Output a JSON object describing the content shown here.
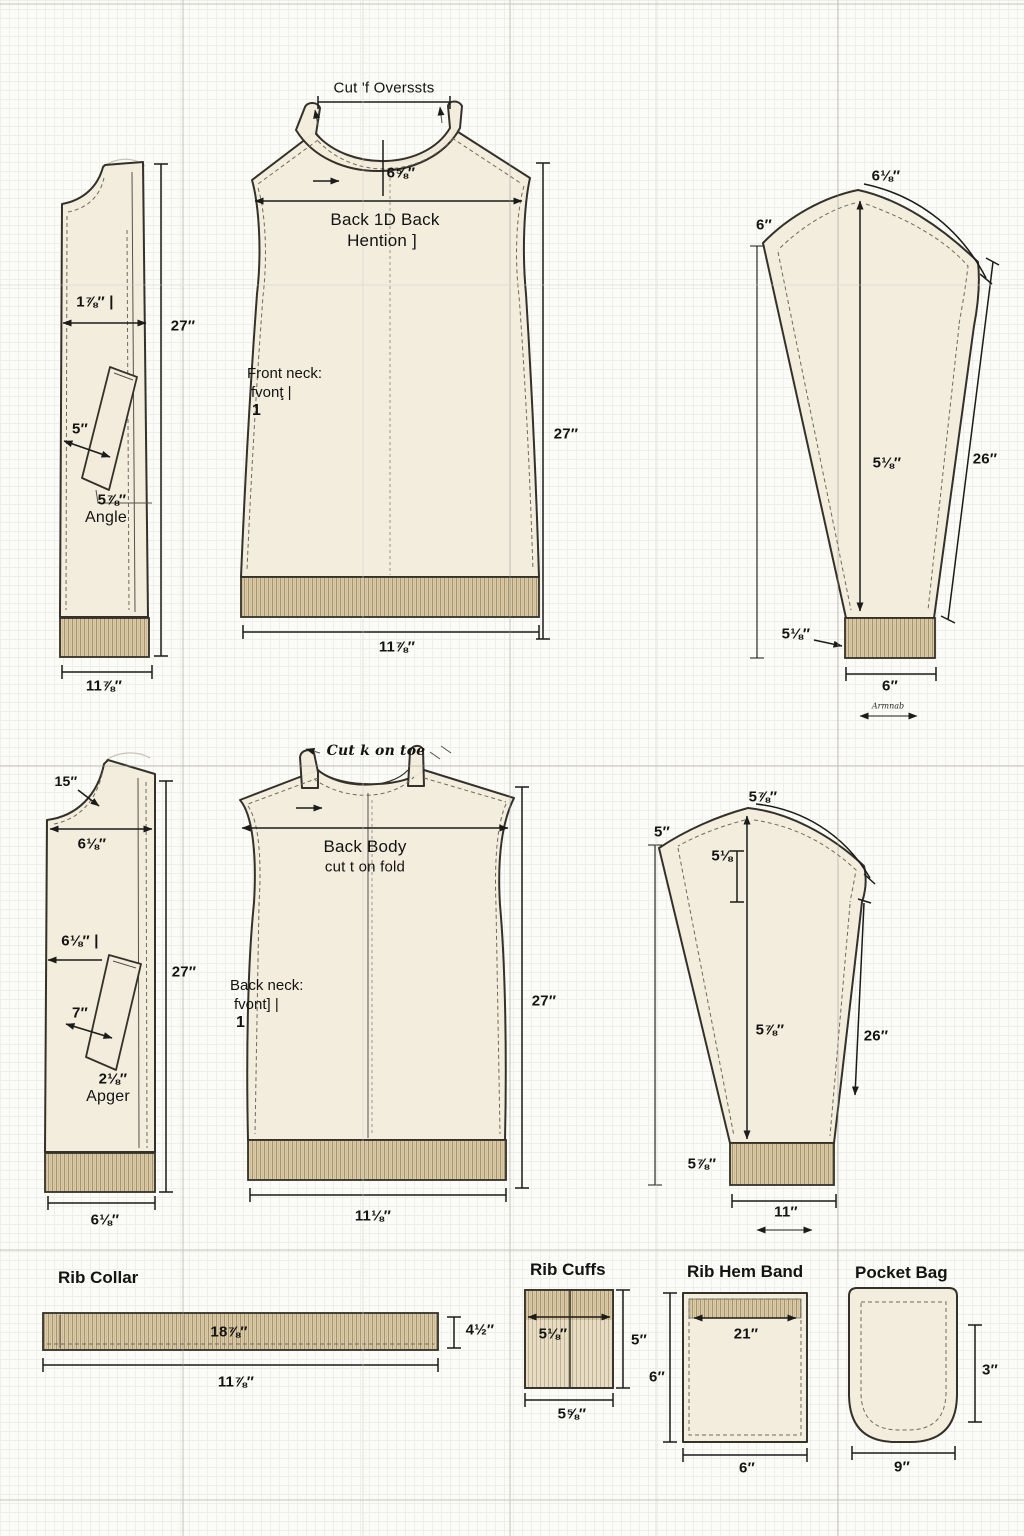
{
  "colors": {
    "fabric": "#f3ecdc",
    "rib_band": "#d9c9a7",
    "rib_line": "#a6946e",
    "outline": "#34312a",
    "paper": "#fbfbf7",
    "dimension": "#1b1b19"
  },
  "top_row": {
    "side_panel": {
      "width_dim": "1⅞″ |",
      "length_dim": "27″",
      "pocket_dim": "5″",
      "angle_dim": "5⅞″",
      "angle_label": "Angle",
      "bottom_dim": "11⅞″"
    },
    "front_body": {
      "cut_note": "Cut 'f Overssts",
      "neck_dim": "6⅝″",
      "name_line1": "Back 1D Back",
      "name_line2": "Hention ]",
      "neck_note_line1": "Front neck:",
      "neck_note_line2": "fvonţ |",
      "neck_note_line3": "1",
      "length_dim": "27″",
      "bottom_dim": "11⅞″"
    },
    "sleeve": {
      "cap_dim": "6⅛″",
      "top_left_dim": "6″",
      "center_dim": "5⅛″",
      "side_dim": "26″",
      "cuff_dim": "5⅛″",
      "cuff_width_dim": "6″",
      "grain_note": "Armnab"
    }
  },
  "middle_row": {
    "side_panel": {
      "neck_dim": "15″",
      "top_width_dim": "6⅛″",
      "mid_width_dim": "6⅛″ |",
      "pocket_dim": "7″",
      "angle_dim": "2⅛″",
      "angle_label": "Apger",
      "length_dim": "27″",
      "bottom_dim": "6⅛″"
    },
    "back_body": {
      "cut_note": "Cut k on toe",
      "name_line1": "Back Body",
      "name_line2": "cut t on fold",
      "neck_note_line1": "Back neck:",
      "neck_note_line2": "fvont] |",
      "neck_note_line3": "1",
      "length_dim": "27″",
      "bottom_dim": "11⅛″"
    },
    "sleeve": {
      "cap_dim": "5⅞″",
      "top_left_dim": "5″",
      "cap_height_dim": "5⅛",
      "center_dim": "5⅞″",
      "side_dim": "26″",
      "cuff_dim": "5⅞″",
      "cuff_width_dim": "11″"
    }
  },
  "bottom_row": {
    "rib_collar": {
      "title": "Rib Collar",
      "inner_dim": "18⅞″",
      "height_dim": "4½″",
      "width_dim": "11⅞″"
    },
    "rib_cuffs": {
      "title": "Rib Cuffs",
      "inner_dim": "5⅛″",
      "height_dim": "5″",
      "width_dim": "5⅝″"
    },
    "rib_hem_band": {
      "title": "Rib Hem Band",
      "inner_dim": "21″",
      "height_dim": "6″",
      "width_dim": "6″"
    },
    "pocket_bag": {
      "title": "Pocket Bag",
      "height_dim": "3″",
      "width_dim": "9″"
    }
  }
}
